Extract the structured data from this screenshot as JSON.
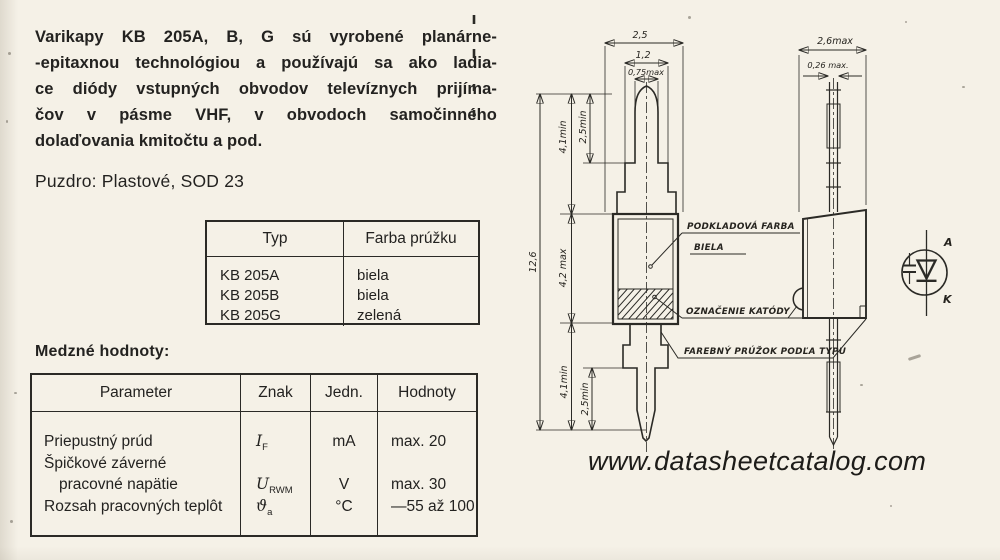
{
  "page": {
    "background": "#f5f1e7",
    "ink": "#232220"
  },
  "intro": {
    "lines": [
      "Varikapy KB 205A, B, G sú vyrobené planárne-",
      "-epitaxnou technológiou a používajú sa ako ladia-",
      "ce diódy vstupných obvodov televíznych prijíma-",
      "čov v pásme VHF, v obvodoch samočinného",
      "dolaďovania kmitočtu a pod."
    ]
  },
  "package_line": "Puzdro: Plastové, SOD 23",
  "type_table": {
    "col_typ": "Typ",
    "col_farba": "Farba prúžku",
    "rows": [
      {
        "typ": "KB 205A",
        "farba": "biela"
      },
      {
        "typ": "KB 205B",
        "farba": "biela"
      },
      {
        "typ": "KB 205G",
        "farba": "zelená"
      }
    ]
  },
  "limits": {
    "title": "Medzné hodnoty:",
    "col_parameter": "Parameter",
    "col_znak": "Znak",
    "col_jedn": "Jedn.",
    "col_hodnoty": "Hodnoty",
    "rows": [
      {
        "parameter": "Priepustný prúd",
        "znak": "I",
        "znak_sub": "F",
        "jedn": "mA",
        "hodnoty": "max. 20"
      },
      {
        "parameter": "Špičkové záverné",
        "parameter2": "pracovné napätie",
        "znak": "U",
        "znak_sub": "RWM",
        "jedn": "V",
        "hodnoty": "max. 30"
      },
      {
        "parameter": "Rozsah pracovných teplôt",
        "znak": "ϑ",
        "znak_sub": "a",
        "jedn": "°C",
        "hodnoty": "—55 až 100"
      }
    ]
  },
  "drawing": {
    "front": {
      "dim_body_width": "2,5",
      "dim_lead_step_width": "1,2",
      "dim_pin_width": "0,75max",
      "dim_pin_len_top": "2,5min",
      "dim_lead_len_top": "4,1min",
      "dim_total_length": "12,6",
      "dim_body_length": "4,2 max",
      "dim_lead_len_bottom": "4,1min",
      "dim_pin_len_bottom": "2,5min"
    },
    "side": {
      "dim_body_width": "2,6max",
      "dim_lead_width": "0,26 max."
    },
    "callouts": {
      "base_color_line1": "PODKLADOVÁ FARBA",
      "base_color_line2": "BIELA",
      "cathode_mark": "OZNAČENIE KATÓDY",
      "color_stripe": "FAREBNÝ PRÚŽOK PODĽA TYPU"
    },
    "symbol": {
      "anode": "A",
      "cathode": "K"
    }
  },
  "watermark": "www.datasheetcatalog.com"
}
